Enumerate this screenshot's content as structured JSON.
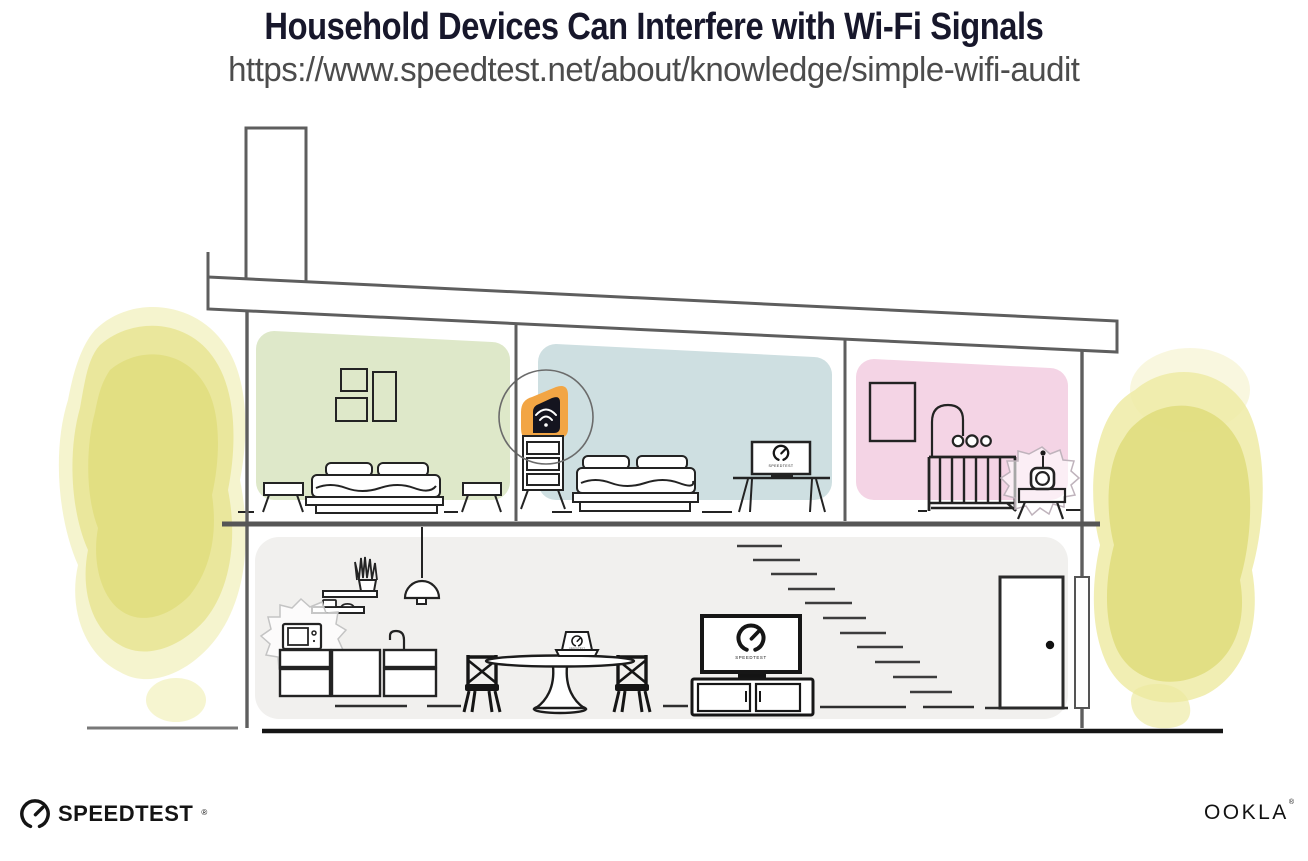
{
  "header": {
    "title": "Household Devices Can Interfere with Wi-Fi Signals",
    "url": "https://www.speedtest.net/about/knowledge/simple-wifi-audit"
  },
  "illustration": {
    "screen_label": "SPEEDTEST",
    "colors": {
      "router_orange": "#F2A544",
      "bedroom_green": "#DEE8C9",
      "bedroom_blue": "#CEDFE1",
      "nursery_pink": "#F4D4E5",
      "living_gray": "#F1F0EE",
      "tree_yellow": "#E0DD7E",
      "line_gray": "#5E5E5E",
      "ink": "#1F1F1F"
    }
  },
  "footer": {
    "speedtest_logo_text": "SPEEDTEST",
    "speedtest_reg_mark": "®",
    "ookla_logo_text": "OOKLA",
    "ookla_reg_mark": "®"
  }
}
